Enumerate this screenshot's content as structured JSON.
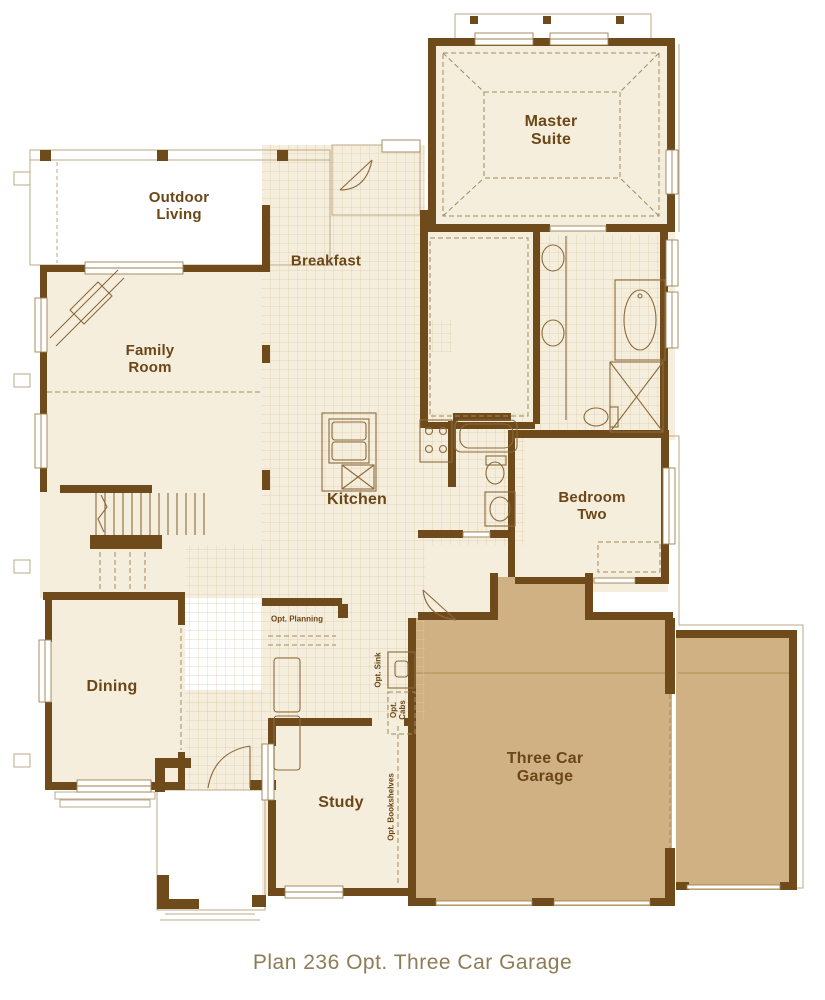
{
  "plan": {
    "rooms": {
      "master_suite": "Master\nSuite",
      "outdoor_living": "Outdoor\nLiving",
      "breakfast": "Breakfast",
      "family_room": "Family\nRoom",
      "kitchen": "Kitchen",
      "bedroom_two": "Bedroom\nTwo",
      "dining": "Dining",
      "study": "Study",
      "garage": "Three Car\nGarage"
    },
    "options": {
      "planning": "Opt. Planning",
      "sink": "Opt. Sink",
      "cabs": "Opt.\nCabs",
      "bookshelves": "Opt. Bookshelves"
    },
    "caption": "Plan 236 Opt. Three Car Garage",
    "colors": {
      "wall": "#6f4a1a",
      "floor": "#f6eedd",
      "tile_line": "#d8c7a5",
      "garage_floor": "#d0b183",
      "label_text": "#6b4717",
      "caption_text": "#8d7c55",
      "thin_line": "#bda887",
      "fixture_line": "#8a6a3c",
      "dash_line": "#a08a5e"
    }
  }
}
